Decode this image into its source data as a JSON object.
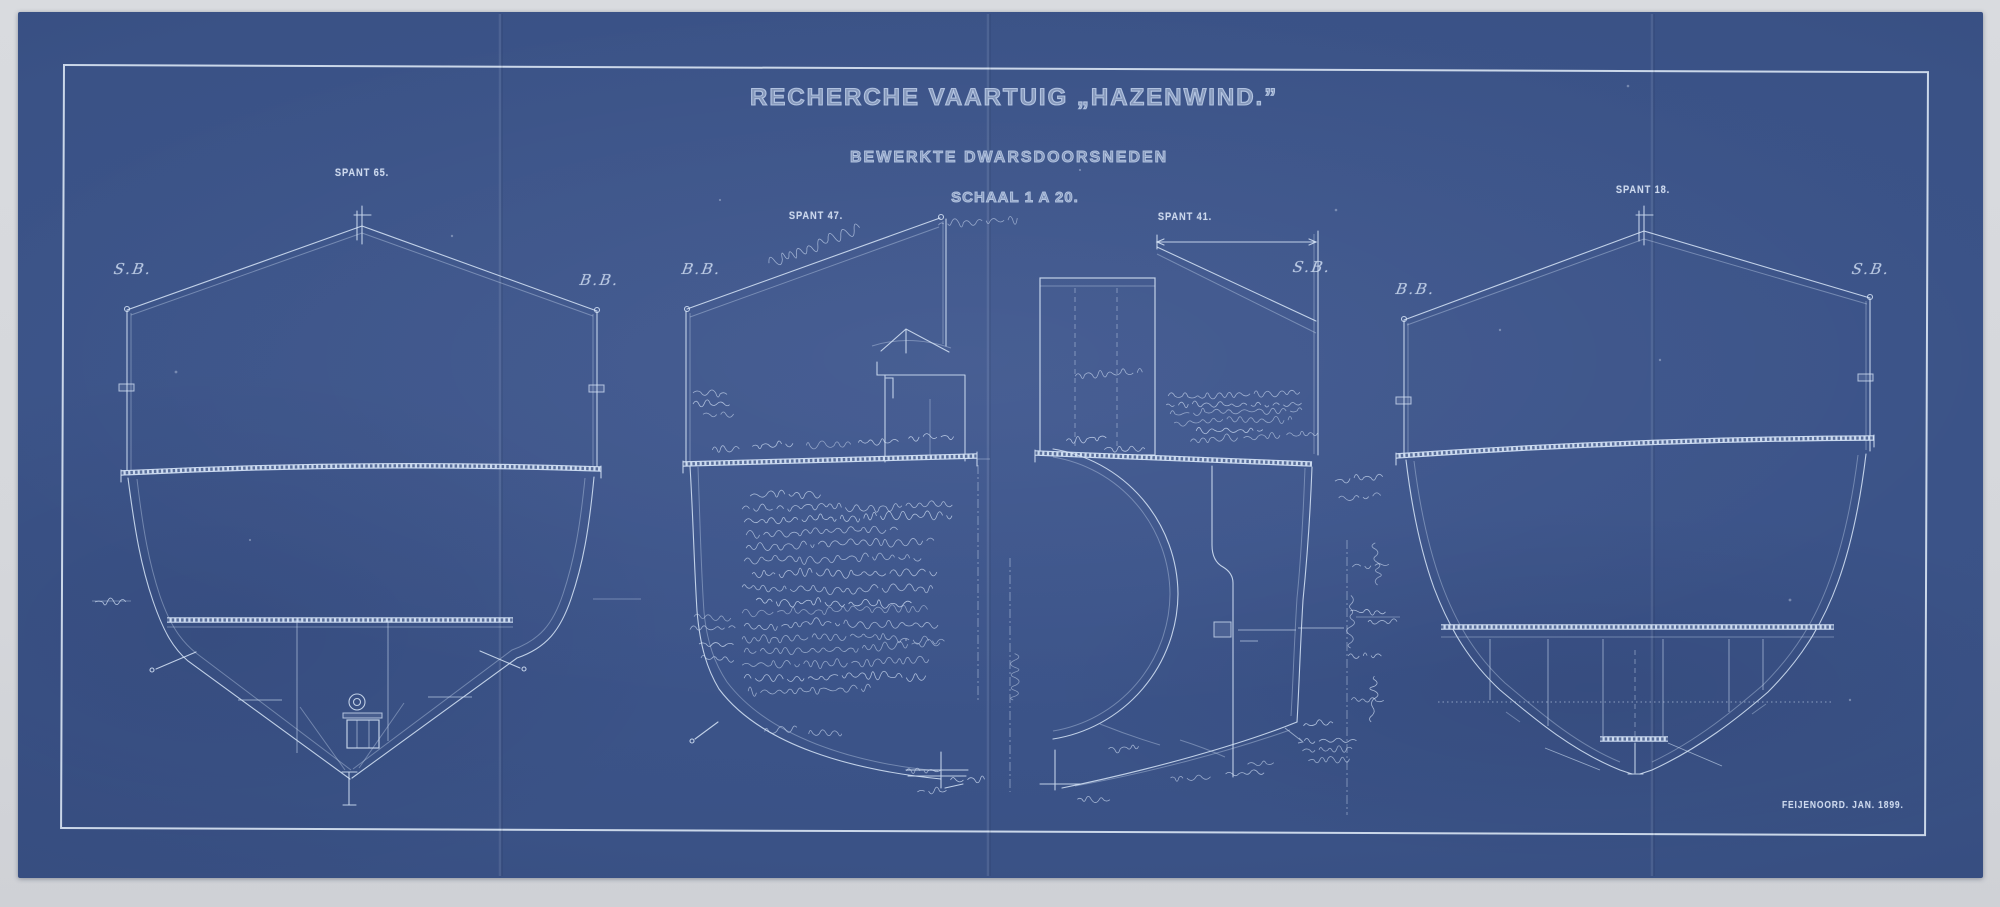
{
  "header": {
    "title": "RECHERCHE VAARTUIG „HAZENWIND.”",
    "subtitle": "BEWERKTE DWARSDOORSNEDEN",
    "scale": "SCHAAL 1 A 20."
  },
  "sections": [
    {
      "id": "spant-65",
      "label": "SPANT 65.",
      "side_marks": {
        "left": "S.B.",
        "right": "B.B."
      }
    },
    {
      "id": "spant-47",
      "label": "SPANT 47.",
      "side_marks": {
        "left": "B.B."
      }
    },
    {
      "id": "spant-41",
      "label": "SPANT 41.",
      "side_marks": {
        "right": "S.B."
      }
    },
    {
      "id": "spant-18",
      "label": "SPANT 18.",
      "side_marks": {
        "left": "B.B.",
        "right": "S.B."
      }
    }
  ],
  "footer": {
    "signature": "FEIJENOORD. JAN. 1899."
  },
  "handwritten_annotations_legible": false,
  "colors": {
    "paper": "#3a5286",
    "lines": "#d6e2f4",
    "background": "#d7d9dd"
  }
}
